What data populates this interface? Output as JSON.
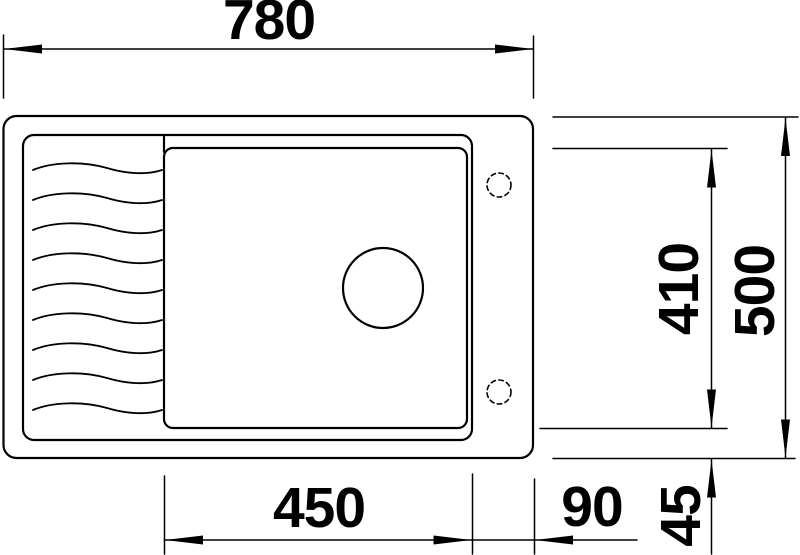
{
  "drawing": {
    "type": "sink-dimension-diagram",
    "colors": {
      "line": "#000000",
      "background": "#ffffff"
    },
    "labels": {
      "overall_width": "780",
      "overall_depth": "500",
      "bowl_depth": "410",
      "bowl_width": "450",
      "right_offset": "90",
      "bottom_offset": "45"
    }
  }
}
